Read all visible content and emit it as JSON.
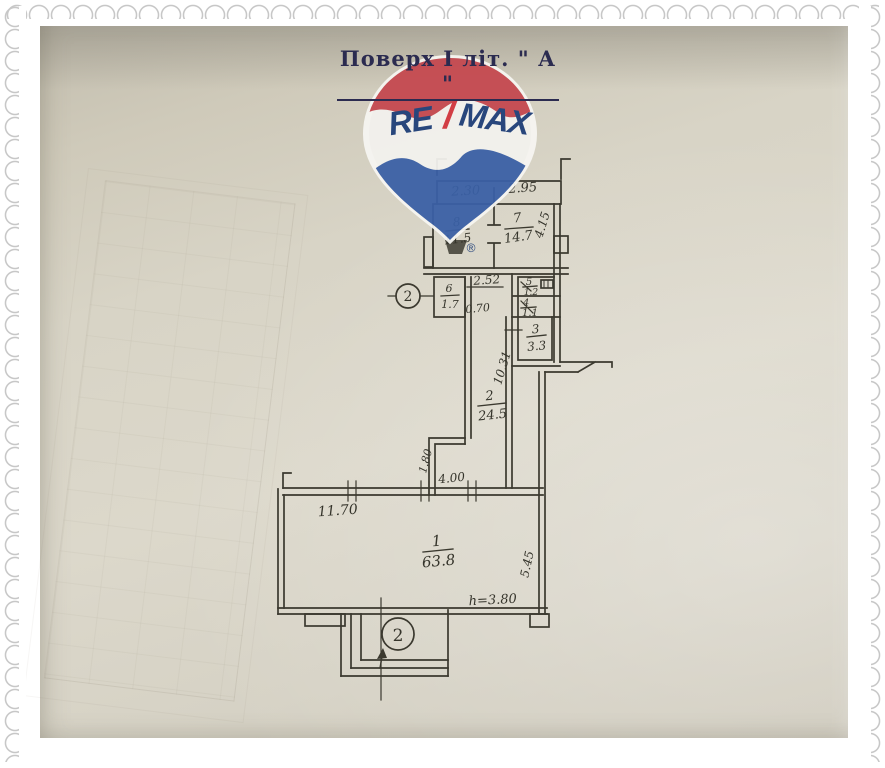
{
  "title": {
    "text": "Поверх  І  літ. \" А \""
  },
  "logo": {
    "re": "RE",
    "slash": "/",
    "max": "MAX",
    "registered": "®",
    "red": "#c5484f",
    "blue": "#3a60a6",
    "text_navy": "#1e3e78"
  },
  "plan": {
    "line_color": "#3b392f",
    "paper_color": "#d8d4c6",
    "rooms": [
      {
        "num": "8",
        "area": "11.5"
      },
      {
        "num": "7",
        "area": "14.7"
      },
      {
        "num": "6",
        "area": "1.7"
      },
      {
        "num": "5",
        "area": "1.2"
      },
      {
        "num": "4",
        "area": "1.1"
      },
      {
        "num": "3",
        "area": "3.3"
      },
      {
        "num": "2",
        "area": "24.5"
      },
      {
        "num": "1",
        "area": "63.8"
      }
    ],
    "dims": {
      "w230": "2.30",
      "w295": "2.95",
      "h415": "4.15",
      "w252": "2.52",
      "w070": "0.70",
      "h1031": "10.31",
      "h180": "1.80",
      "w400": "4.00",
      "w1170": "11.70",
      "h545": "5.45",
      "ceiling": "h=3.80"
    },
    "markers": {
      "left": "2",
      "bottom": "2"
    }
  }
}
